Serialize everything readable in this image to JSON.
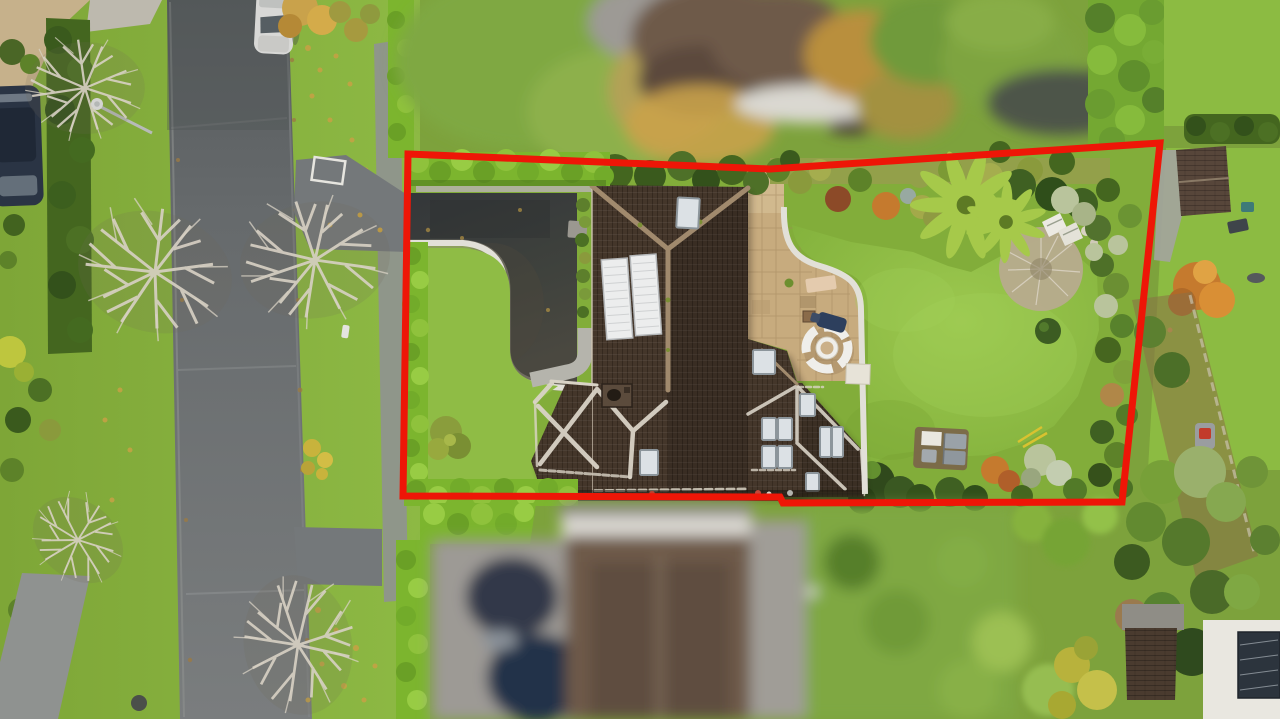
{
  "scene": {
    "title": "Aerial drone photograph of a detached suburban property with a red site-boundary outline overlay; neighbouring houses blurred for privacy",
    "view": "top-down aerial",
    "season": "autumn"
  },
  "boundary": {
    "color": "#ee1607",
    "stroke_width": 7,
    "points": "408,154 770,169 1160,143 1122,502 783,503 780,497 403,496"
  },
  "colors": {
    "grassVerge": "#84ac3c",
    "grassLight": "#97c04a",
    "lawn": "#8cbb42",
    "lawnLight": "#a3cf58",
    "lawnDark": "#76a232",
    "hedgeBright": "#7cb52e",
    "hedgeBrightHi": "#9ace46",
    "hedgeDark": "#44661f",
    "hedgeDarker": "#33511b",
    "shrubOlive": "#8a9a3c",
    "shrubSage": "#b9c49c",
    "mossHedge": "#93a04a",
    "road": "#696d6f",
    "roadDark": "#585c5e",
    "roadLight": "#797c7d",
    "footpath": "#8f9290",
    "apron": "#74787a",
    "kerbLeaf": "#9b7b43",
    "driveway": "#3f423d",
    "drivewayDark": "#313431",
    "drivewayBrown": "#4c473c",
    "edging": "#e2e0d8",
    "edgingShadow": "#97927f",
    "gravel": "#b3b1a7",
    "path": "#b5b4ac",
    "roofDark": "#44362a",
    "roofDarker": "#322920",
    "ridgeTan": "#a18a6d",
    "ridgeWhite": "#d9d3c6",
    "panelWhite": "#eceded",
    "panelLine": "#b4b7b9",
    "velux": "#dce1e5",
    "veluxFrame": "#8c959b",
    "chimney": "#5b4b3c",
    "chimneyPot": "#231c15",
    "patio": "#c7ab7e",
    "patioLight": "#d7c096",
    "patioLine": "#a2875d",
    "furnWhite": "#efeeea",
    "furnTan": "#cbb089",
    "loungerNavy": "#2d3f5d",
    "matTan": "#e4cbae",
    "fernGreen": "#a6c94a",
    "fernDark": "#5d7a24",
    "autumnOrange": "#c57a2e",
    "autumnRed": "#8c4a28",
    "autumnGold": "#c9a24b",
    "leafGold": "#c8a145",
    "twig": "#d8d1c4",
    "twigShrub": "#b7ab8e",
    "blurRoofBrown": "#6e5a49",
    "blurGrey": "#9d9a95",
    "blurWhite": "#dad8d1",
    "blurGreen": "#7fa843",
    "blurDarkGreen": "#4a6626",
    "carNavy": "#2a3444",
    "carWhite": "#d8d8d6",
    "shedRoof": "#57463a",
    "brickWall": "#4a3b2f",
    "whiteBldg": "#e9e7e0",
    "solarNavy": "#2c343d",
    "toolYellow": "#d9c230",
    "mowerRed": "#c23b2a",
    "tealItem": "#3e7a78"
  },
  "objects": [
    {
      "name": "property-boundary-outline",
      "label": "Red outlined site boundary"
    },
    {
      "name": "main-house-roof",
      "label": "Detached house with dark tiled hipped roofs"
    },
    {
      "name": "solar-panel-array",
      "label": "Two white panels on main roof slope"
    },
    {
      "name": "roof-skylights",
      "label": "Multiple roof skylight windows"
    },
    {
      "name": "chimney",
      "label": "Brick chimney on ridge"
    },
    {
      "name": "driveway",
      "label": "Dark tarmac driveway with curved light edging"
    },
    {
      "name": "front-lawn",
      "label": "Front lawn with shrub"
    },
    {
      "name": "patio",
      "label": "Stone-paved patio"
    },
    {
      "name": "garden-furniture-set",
      "label": "Circular white garden bench and table"
    },
    {
      "name": "sun-lounger",
      "label": "Navy sun lounger on patio"
    },
    {
      "name": "rear-lawn",
      "label": "Large rear lawn"
    },
    {
      "name": "tree-ferns",
      "label": "Tree ferns in planted border"
    },
    {
      "name": "leafless-shrub",
      "label": "Round leafless twiggy shrub on lawn"
    },
    {
      "name": "garden-sofa-set",
      "label": "Grey garden sofa set near rear border"
    },
    {
      "name": "road",
      "label": "Residential road with grass verges and footpaths"
    },
    {
      "name": "white-car",
      "label": "White car parked at top of road"
    },
    {
      "name": "dark-car",
      "label": "Dark car parked at left edge"
    },
    {
      "name": "street-lamp",
      "label": "Street lamp on verge"
    },
    {
      "name": "bare-trees",
      "label": "Leafless autumn trees on verges"
    },
    {
      "name": "neighbor-house-top",
      "label": "Blurred neighbouring house (top)"
    },
    {
      "name": "neighbor-house-bottom",
      "label": "Blurred neighbouring house (bottom)"
    },
    {
      "name": "neighbor-shed",
      "label": "Neighbour's shed"
    },
    {
      "name": "neighbor-outbuilding",
      "label": "White outbuilding with dark solar panel"
    },
    {
      "name": "autumn-tree",
      "label": "Orange autumn tree in neighbouring garden"
    }
  ]
}
